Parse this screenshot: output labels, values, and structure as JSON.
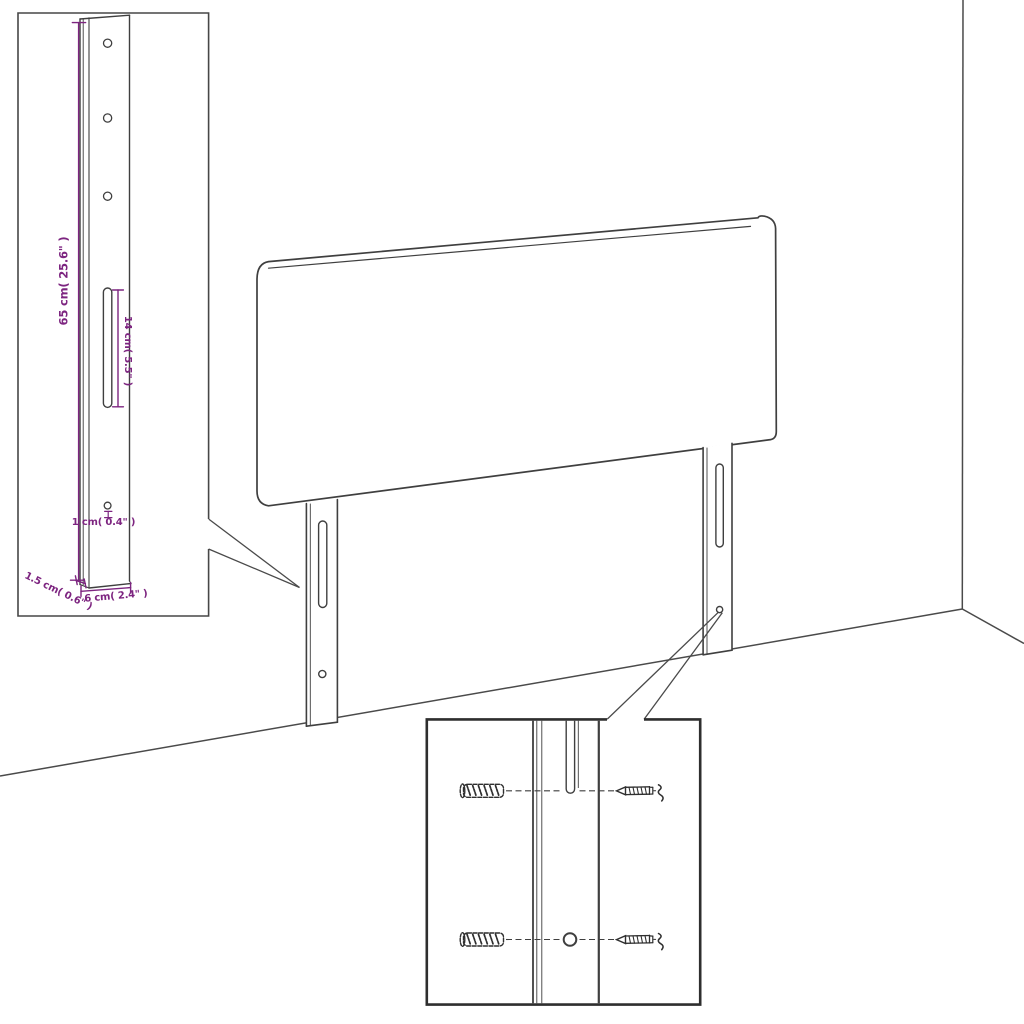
{
  "diagram": {
    "kind": "headboard assembly / dimension diagram",
    "colors": {
      "line": "#3f3f3f",
      "room_line": "#4a4a4a",
      "dimension_accent": "#7d2580",
      "background": "#ffffff"
    }
  },
  "labels": {
    "leg_height": "65 cm( 25.6\" )",
    "slot_length": "14 cm( 5.5\" )",
    "hole_diameter": "1 cm( 0.4\" )",
    "leg_depth": "1.5 cm( 0.6\" )",
    "leg_width": "6 cm( 2.4\" )"
  },
  "icons": {
    "wall_anchor_icon": "hatched wall-plug shape",
    "screw_icon": "pointed screw with break squiggle"
  }
}
